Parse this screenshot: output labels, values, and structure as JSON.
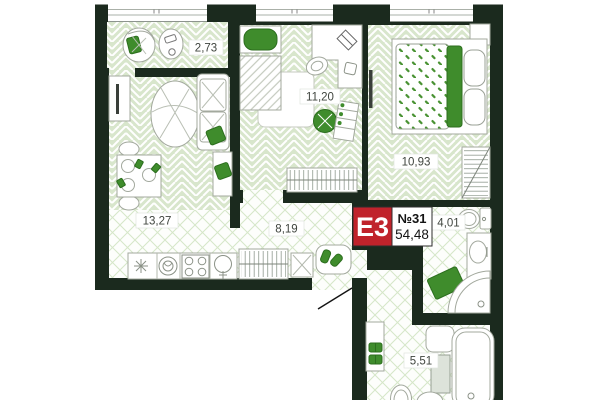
{
  "plan": {
    "badge": {
      "type_label": "E3",
      "unit_label": "№31",
      "area_total": "54,48"
    },
    "rooms": [
      {
        "id": "balcony",
        "area": "2,73"
      },
      {
        "id": "bedroom-kids",
        "area": "11,20"
      },
      {
        "id": "bedroom-master",
        "area": "10,93"
      },
      {
        "id": "kitchen-living",
        "area": "13,27"
      },
      {
        "id": "hallway",
        "area": "8,19"
      },
      {
        "id": "wc",
        "area": "4,01"
      },
      {
        "id": "bathroom",
        "area": "5,51"
      }
    ],
    "colors": {
      "wall": "#1b2a1e",
      "floor_green": "#d8e6cc",
      "accent_green": "#3f8c2c",
      "badge_red": "#c0232b"
    }
  }
}
